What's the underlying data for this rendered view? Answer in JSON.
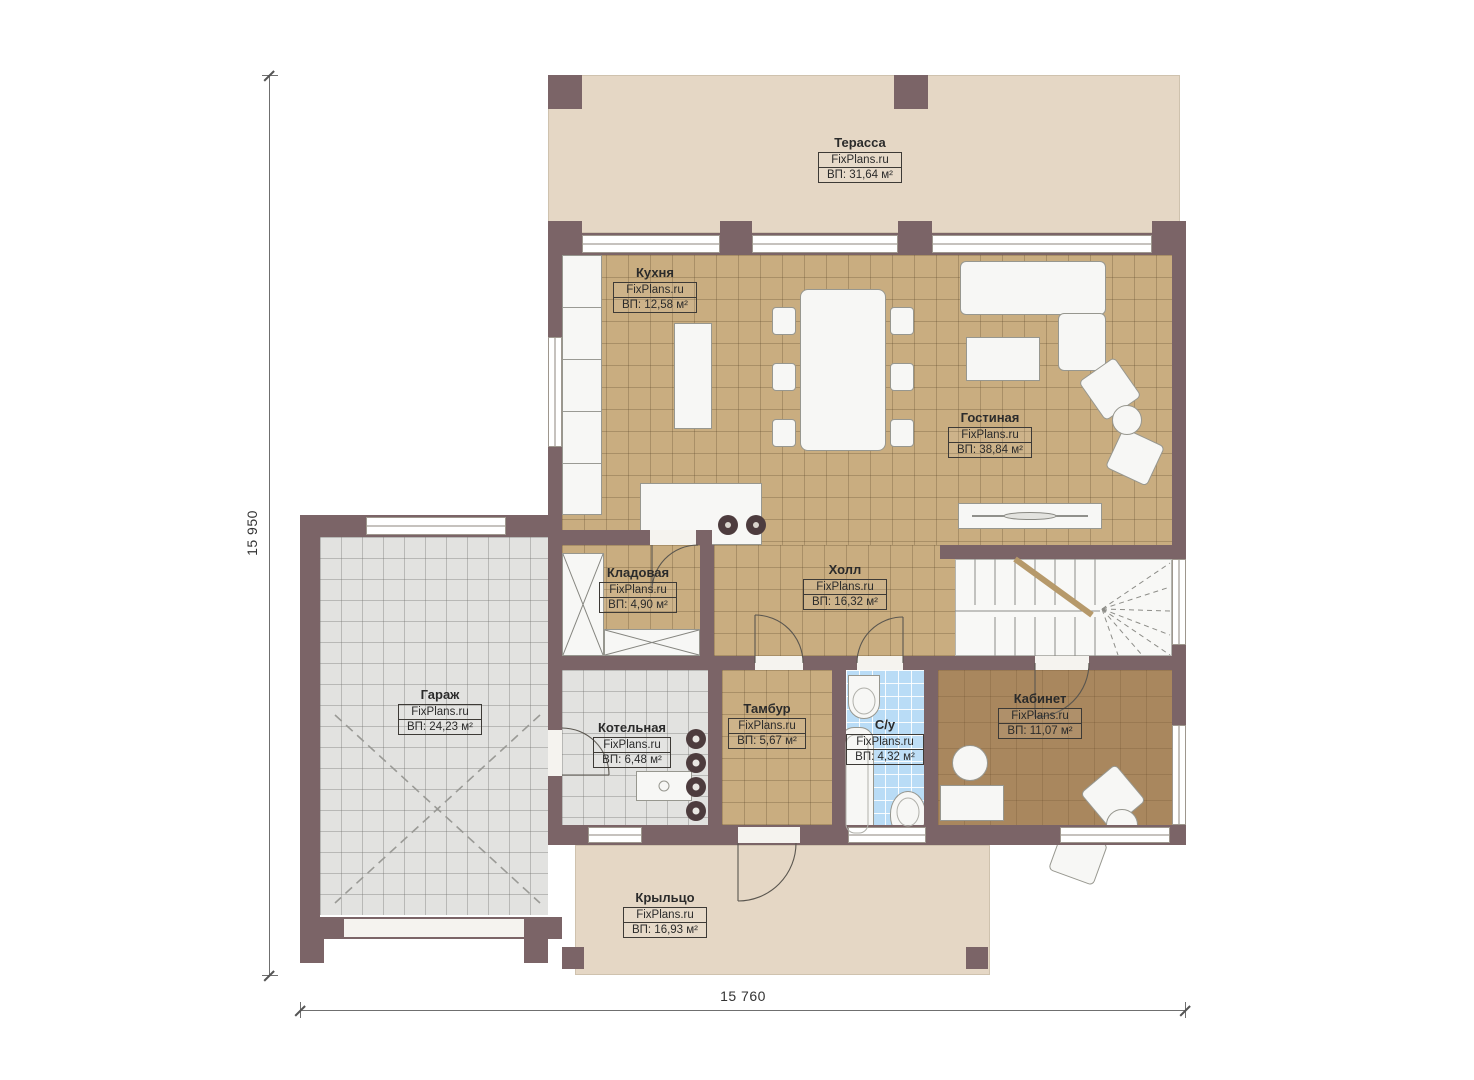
{
  "brand": "FixPlans.ru",
  "dimensions": {
    "left": "15 950",
    "bottom": "15 760"
  },
  "rooms": {
    "terrace": {
      "name": "Терасса",
      "area": "ВП: 31,64 м²"
    },
    "kitchen": {
      "name": "Кухня",
      "area": "ВП: 12,58 м²"
    },
    "living": {
      "name": "Гостиная",
      "area": "ВП: 38,84 м²"
    },
    "pantry": {
      "name": "Кладовая",
      "area": "ВП: 4,90 м²"
    },
    "hall": {
      "name": "Холл",
      "area": "ВП: 16,32 м²"
    },
    "garage": {
      "name": "Гараж",
      "area": "ВП: 24,23 м²"
    },
    "boiler": {
      "name": "Котельная",
      "area": "ВП: 6,48 м²"
    },
    "vestibule": {
      "name": "Тамбур",
      "area": "ВП: 5,67 м²"
    },
    "bathroom": {
      "name": "С/у",
      "area": "ВП: 4,32 м²"
    },
    "office": {
      "name": "Кабинет",
      "area": "ВП: 11,07 м²"
    },
    "porch": {
      "name": "Крыльцо",
      "area": "ВП: 16,93 м²"
    }
  },
  "palette": {
    "wall": "#7b6467",
    "terrace_fill": "#e5d7c5",
    "tile_tan": "#c9ad80",
    "tile_gray": "#e2e2e0",
    "tile_blue": "#b9dcf6",
    "floor_wood": "#a9875e"
  }
}
